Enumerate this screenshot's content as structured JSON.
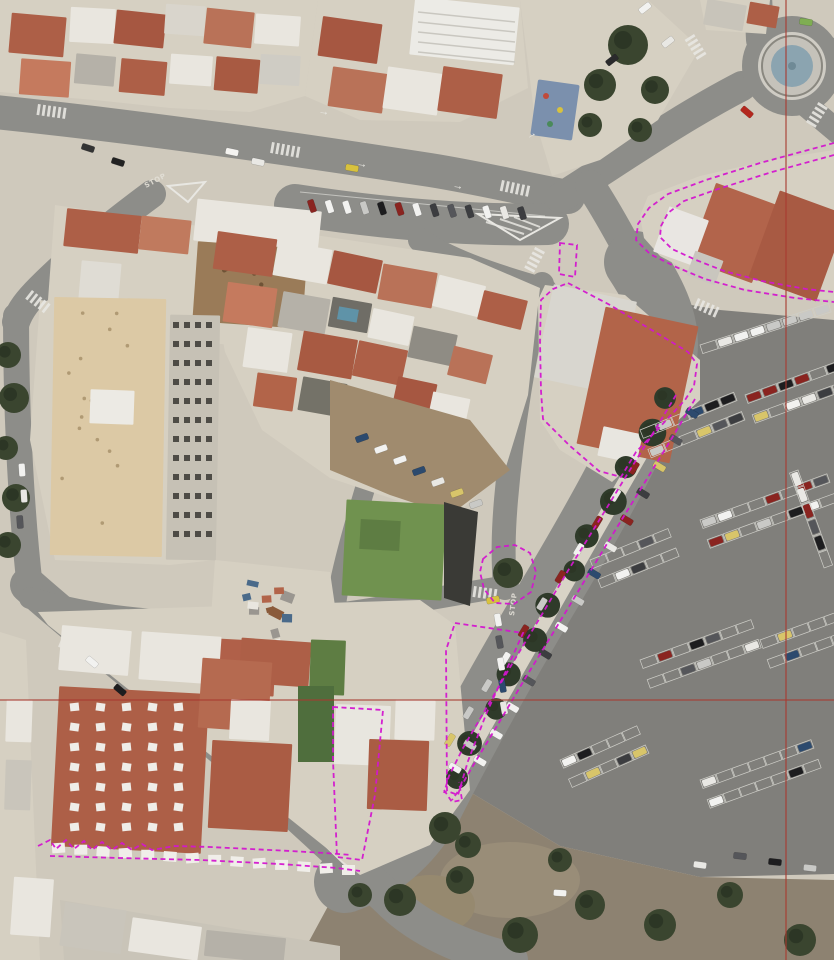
{
  "viewer": {
    "type": "aerial-orthophoto-gis-view",
    "canvas": {
      "width": 834,
      "height": 960
    },
    "crosshair": {
      "x": 786,
      "y": 700,
      "color": "#a83a30"
    },
    "road_markings": [
      {
        "label": "STOP",
        "x": 146,
        "y": 188,
        "rotation": -28
      },
      {
        "label": "STOP",
        "x": 514,
        "y": 616,
        "rotation": -83
      }
    ],
    "palette": {
      "asphalt": "#8d8d89",
      "parking_asphalt": "#807f7b",
      "sidewalk": "#cfc9bc",
      "block_beige": "#d6d0c2",
      "plaza_tan": "#dcc9a5",
      "roof_terracotta": "#ad5f47",
      "roof_white": "#e9e6df",
      "roof_green": "#70924f",
      "vegetation": "#3a452f",
      "dirt": "#8d8271",
      "fountain_water": "#8ba4b0",
      "bay_line": "#cfcfc9",
      "road_paint": "#e8e7e2"
    },
    "annotation": {
      "color": "#d316cf",
      "line_style": "dashed",
      "shapes": [
        {
          "id": "parcel-northeast-block-outer",
          "type": "polyline",
          "points": "834,143 760,163 706,180 668,194 649,208 638,224 636,240 650,254 676,267 705,279 745,290 795,298 834,302"
        },
        {
          "id": "parcel-northeast-block-inner",
          "type": "polyline",
          "points": "834,155 772,172 718,189 684,201 668,213 661,226 660,237 672,249 696,260 724,271 762,281 806,289 834,292"
        },
        {
          "id": "parcel-central-building",
          "type": "polygon",
          "points": "568,283 610,305 655,332 688,352 697,364 694,386 685,400 658,429 636,452 621,477 599,471 570,446 543,419 541,391 540,341 541,300 553,289"
        },
        {
          "id": "parcel-kiosk",
          "type": "polygon",
          "points": "560,243 577,245 575,277 559,274"
        },
        {
          "id": "avenue-strip-outer",
          "type": "polyline",
          "points": "695,399 672,438 645,482 616,529 585,580 553,633 523,682 497,726 474,764 459,790 452,800"
        },
        {
          "id": "avenue-strip-inner",
          "type": "polyline",
          "points": "676,395 655,430 628,473 600,519 569,569 538,621 509,669 484,712 463,748 449,776 444,793"
        },
        {
          "id": "avenue-strip-cap",
          "type": "polyline",
          "points": "444,790 452,802 462,800 459,782"
        },
        {
          "id": "sidewalk-strip-west",
          "type": "polygon",
          "points": "455,623 523,633 505,673 487,712 468,761 458,795 447,791 446,650"
        },
        {
          "id": "tree-island",
          "type": "polygon",
          "points": "483,559 497,547 515,545 530,553 536,572 531,592 514,604 495,603 484,589 480,572"
        },
        {
          "id": "parcel-south-building",
          "type": "polygon",
          "points": "333,707 383,710 375,795 362,860 337,857 333,760"
        },
        {
          "id": "boundary-southwest-scribble",
          "type": "polyline",
          "points": "38,846 50,840 56,849 66,840 74,849 84,841 92,850 102,842 112,850 122,843 132,850 142,844 152,850 175,846 210,847 250,849 290,851 325,853 352,855"
        },
        {
          "id": "boundary-southwest-lower",
          "type": "polyline",
          "points": "50,856 120,858 200,860 280,864 337,868 360,871"
        }
      ]
    }
  }
}
